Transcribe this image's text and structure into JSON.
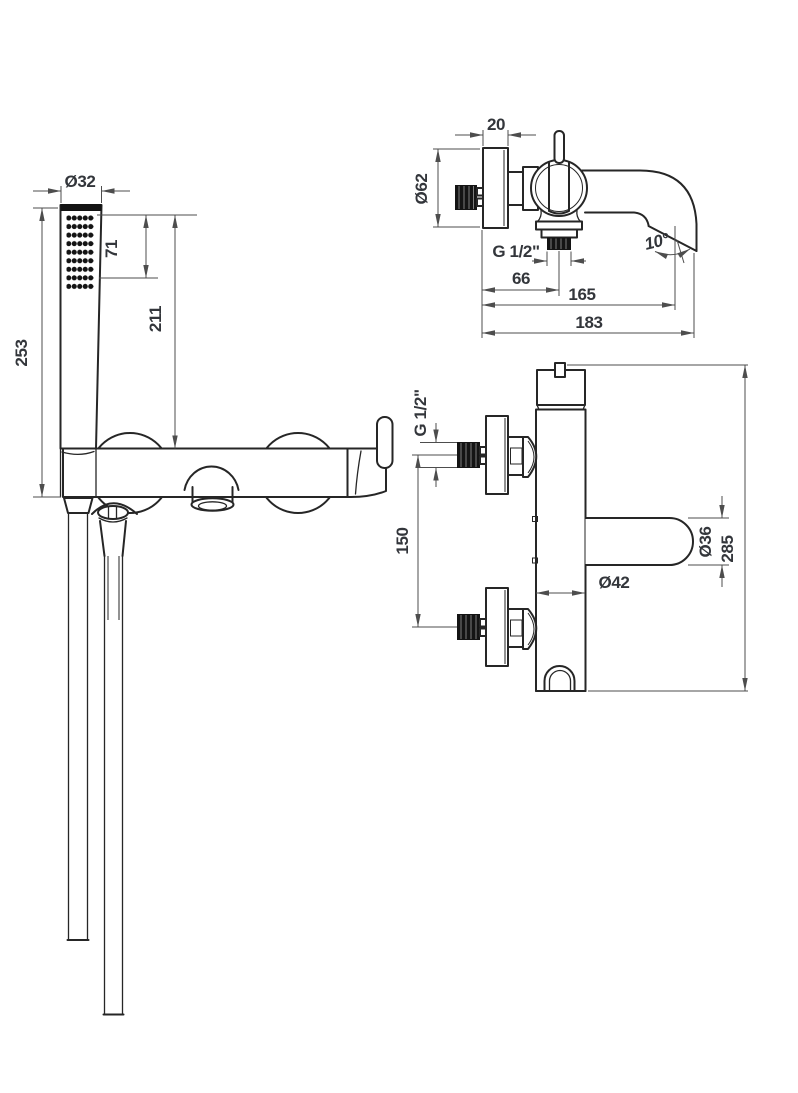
{
  "page": {
    "title": "Wall-mounted bath mixer with hand shower — dimensional technical drawing",
    "background": "#ffffff"
  },
  "colors": {
    "outline": "#262626",
    "dimension_lines": "#4d4d4d",
    "dimension_text": "#33363b",
    "solid_fill": "#141414"
  },
  "views": {
    "hand_shower_front": {
      "name": "hand-shower-with-hose-front-view",
      "dims": {
        "head_diameter": "Ø32",
        "spray_face_length": "71",
        "head_to_body_top": "211",
        "total_length": "253"
      }
    },
    "mixer_side": {
      "name": "bath-mixer-side-view",
      "dims": {
        "wall_plate_depth": "20",
        "rosette_diameter": "Ø62",
        "outlet_thread": "G 1/2\"",
        "wall_to_outlet_axis": "66",
        "wall_to_spout_inner": "165",
        "wall_to_spout_tip": "183",
        "spout_angle": "10°"
      }
    },
    "mixer_back": {
      "name": "bath-mixer-rear-view",
      "dims": {
        "connection_thread": "G 1/2\"",
        "connection_spacing": "150",
        "spout_diameter": "Ø36",
        "body_diameter": "Ø42",
        "total_height": "285"
      }
    }
  }
}
